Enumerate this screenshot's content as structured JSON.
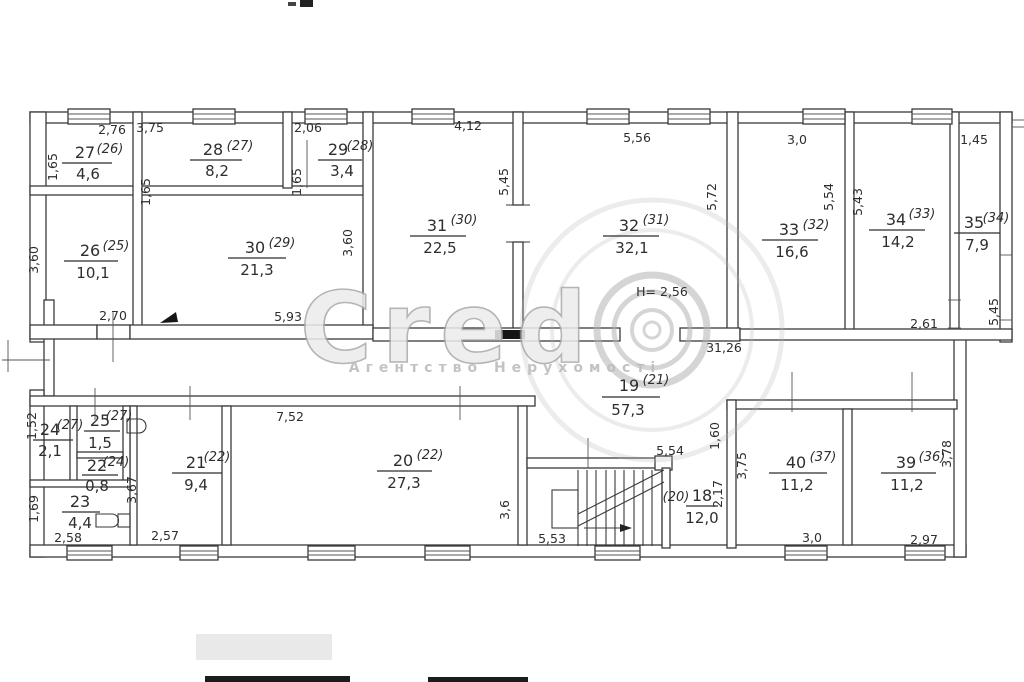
{
  "watermark": {
    "brand": "Credo",
    "brand_letters": "Cred",
    "subtitle": "Агентство Нерухомості"
  },
  "notes": {
    "ceiling_height": "Н= 2,56"
  },
  "rooms": {
    "r27": {
      "num": "27",
      "old": "(26)",
      "area": "4,6"
    },
    "r28": {
      "num": "28",
      "old": "(27)",
      "area": "8,2"
    },
    "r29": {
      "num": "29",
      "old": "(28)",
      "area": "3,4"
    },
    "r26": {
      "num": "26",
      "old": "(25)",
      "area": "10,1"
    },
    "r30": {
      "num": "30",
      "old": "(29)",
      "area": "21,3"
    },
    "r31": {
      "num": "31",
      "old": "(30)",
      "area": "22,5"
    },
    "r32": {
      "num": "32",
      "old": "(31)",
      "area": "32,1"
    },
    "r33": {
      "num": "33",
      "old": "(32)",
      "area": "16,6"
    },
    "r34": {
      "num": "34",
      "old": "(33)",
      "area": "14,2"
    },
    "r35": {
      "num": "35",
      "old": "(34)",
      "area": "7,9"
    },
    "r24": {
      "num": "24",
      "old": "(27)",
      "area": "2,1"
    },
    "r25": {
      "num": "25",
      "old": "(27)",
      "area": "1,5"
    },
    "r22": {
      "num": "22",
      "old": "(24)",
      "area": "0,8"
    },
    "r23": {
      "num": "23",
      "old": "",
      "area": "4,4"
    },
    "r21": {
      "num": "21",
      "old": "(22)",
      "area": "9,4"
    },
    "r20": {
      "num": "20",
      "old": "(22)",
      "area": "27,3"
    },
    "r19": {
      "num": "19",
      "old": "(21)",
      "area": "57,3"
    },
    "r18": {
      "num": "18",
      "old": "(20)",
      "area": "12,0"
    },
    "r40": {
      "num": "40",
      "old": "(37)",
      "area": "11,2"
    },
    "r39": {
      "num": "39",
      "old": "(36)",
      "area": "11,2"
    }
  },
  "dims": {
    "top_27": "2,76",
    "top_28": "3,75",
    "top_29": "2,06",
    "top_31": "4,12",
    "top_32": "5,56",
    "top_33": "3,0",
    "top_35": "1,45",
    "left_27": "1,65",
    "mid_28": "1,65",
    "mid_29": "1,65",
    "left_26": "3,60",
    "right_30": "3,60",
    "wall_31_32": "5,45",
    "left_33": "5,72",
    "right_33": "5,54",
    "left_34": "5,43",
    "right_35": "5,45",
    "bottom_34": "2,61",
    "bottom_26": "2,70",
    "bottom_30": "5,93",
    "corridor_total": "31,26",
    "top_20": "7,52",
    "right_20": "3,6",
    "bottom_stairs": "5,53",
    "top_stairs": "5,54",
    "right_corridor": "1,60",
    "right_18": "2,17",
    "left_21": "3,67",
    "left_24": "1,52",
    "left_23": "1,69",
    "bottom_23": "2,58",
    "bottom_21": "2,57",
    "left_40": "3,75",
    "right_39": "3,78",
    "bottom_40": "3,0",
    "bottom_39": "2,97"
  }
}
